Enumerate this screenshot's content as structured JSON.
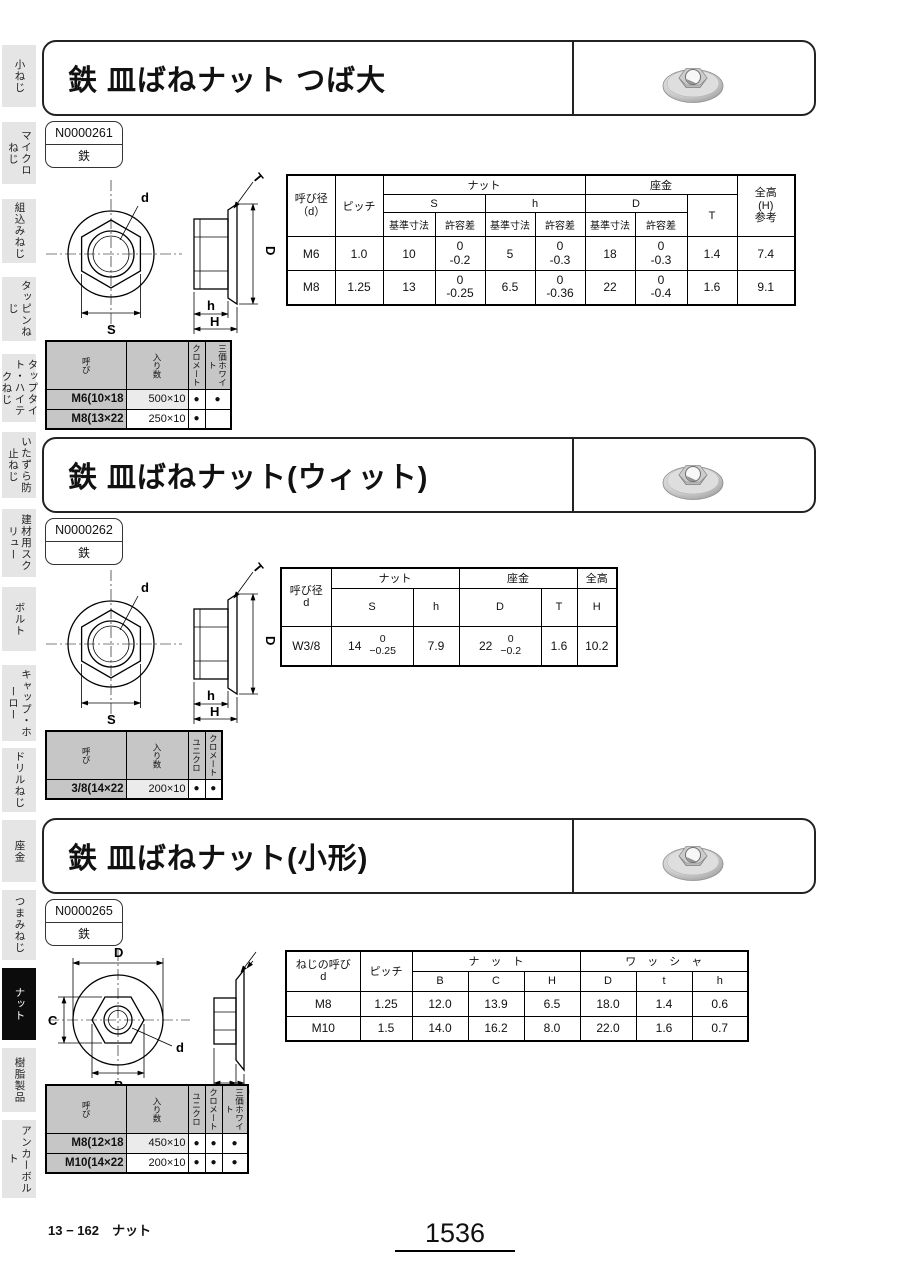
{
  "page": {
    "footer_left": "13 − 162　ナット",
    "footer_page": "1536"
  },
  "sidebar": {
    "items": [
      {
        "label": "小ねじ",
        "active": false
      },
      {
        "label": "マイクロねじ",
        "active": false
      },
      {
        "label": "組込みねじ",
        "active": false
      },
      {
        "label": "タッピンねじ",
        "active": false
      },
      {
        "label": "タップタイト・ハイテクねじ",
        "active": false
      },
      {
        "label": "いたずら防止ねじ",
        "active": false
      },
      {
        "label": "建材用スクリュー",
        "active": false
      },
      {
        "label": "ボルト",
        "active": false
      },
      {
        "label": "キャップ・ホーロー",
        "active": false
      },
      {
        "label": "ドリルねじ",
        "active": false
      },
      {
        "label": "座金",
        "active": false
      },
      {
        "label": "つまみねじ",
        "active": false
      },
      {
        "label": "ナット",
        "active": true
      },
      {
        "label": "樹脂製品",
        "active": false
      },
      {
        "label": "アンカーボルト",
        "active": false
      }
    ]
  },
  "sections": [
    {
      "title": "鉄 皿ばねナット つば大",
      "code": "N0000261",
      "material": "鉄",
      "drawing": {
        "d": "d",
        "S": "S",
        "T": "T",
        "D": "D",
        "h": "h",
        "H": "H"
      },
      "spec": {
        "h_name": "呼び径\n（d）",
        "h_pitch": "ピッチ",
        "h_nut": "ナット",
        "h_washer": "座金",
        "h_total": "全高\n(H)\n参考",
        "h_S": "S",
        "h_h": "h",
        "h_D": "D",
        "h_T": "T",
        "h_basic": "基準寸法",
        "h_tol": "許容差",
        "rows": [
          {
            "name": "M6",
            "pitch": "1.0",
            "s_basic": "10",
            "s_tol": "0\n-0.2",
            "h_basic": "5",
            "h_tol": "0\n-0.3",
            "d_basic": "18",
            "d_tol": "0\n-0.3",
            "t": "1.4",
            "total": "7.4"
          },
          {
            "name": "M8",
            "pitch": "1.25",
            "s_basic": "13",
            "s_tol": "0\n-0.25",
            "h_basic": "6.5",
            "h_tol": "0\n-0.36",
            "d_basic": "22",
            "d_tol": "0\n-0.4",
            "t": "1.6",
            "total": "9.1"
          }
        ]
      },
      "pack": {
        "h_name": "呼び",
        "h_qty": "入り数",
        "finishes": [
          "クロメート",
          "三価ホワイト"
        ],
        "rows": [
          {
            "name": "M6(10×18",
            "qty": "500×10",
            "dots": [
              "●",
              "●"
            ]
          },
          {
            "name": "M8(13×22",
            "qty": "250×10",
            "dots": [
              "●",
              ""
            ]
          }
        ]
      }
    },
    {
      "title": "鉄 皿ばねナット(ウィット)",
      "code": "N0000262",
      "material": "鉄",
      "drawing": {
        "d": "d",
        "S": "S",
        "T": "T",
        "D": "D",
        "h": "h",
        "H": "H"
      },
      "spec": {
        "h_name": "呼び径\nd",
        "h_nut": "ナット",
        "h_washer": "座金",
        "h_total": "全高",
        "h_S": "S",
        "h_h": "h",
        "h_D": "D",
        "h_T": "T",
        "h_H": "H",
        "rows": [
          {
            "name": "W3/8",
            "s_basic": "14",
            "s_tol": "0\n−0.25",
            "h": "7.9",
            "d_basic": "22",
            "d_tol": "0\n−0.2",
            "t": "1.6",
            "total": "10.2"
          }
        ]
      },
      "pack": {
        "h_name": "呼び",
        "h_qty": "入り数",
        "finishes": [
          "ユニクロ",
          "クロメート"
        ],
        "rows": [
          {
            "name": "3/8(14×22",
            "qty": "200×10",
            "dots": [
              "●",
              "●"
            ]
          }
        ]
      }
    },
    {
      "title": "鉄 皿ばねナット(小形)",
      "code": "N0000265",
      "material": "鉄",
      "drawing": {
        "D": "D",
        "C": "C",
        "B": "B",
        "d": "d",
        "H": "H",
        "h": "h"
      },
      "spec": {
        "h_name": "ねじの呼び\nd",
        "h_pitch": "ピッチ",
        "h_nut": "ナ　ッ　ト",
        "h_washer": "ワ　ッ　シ　ャ",
        "cols_nut": [
          "B",
          "C",
          "H"
        ],
        "cols_washer": [
          "D",
          "t",
          "h"
        ],
        "rows": [
          {
            "name": "M8",
            "pitch": "1.25",
            "vals": [
              "12.0",
              "13.9",
              "6.5",
              "18.0",
              "1.4",
              "0.6"
            ]
          },
          {
            "name": "M10",
            "pitch": "1.5",
            "vals": [
              "14.0",
              "16.2",
              "8.0",
              "22.0",
              "1.6",
              "0.7"
            ]
          }
        ]
      },
      "pack": {
        "h_name": "呼び",
        "h_qty": "入り数",
        "finishes": [
          "ユニクロ",
          "クロメート",
          "三価ホワイト"
        ],
        "rows": [
          {
            "name": "M8(12×18",
            "qty": "450×10",
            "dots": [
              "●",
              "●",
              "●"
            ]
          },
          {
            "name": "M10(14×22",
            "qty": "200×10",
            "dots": [
              "●",
              "●",
              "●"
            ]
          }
        ]
      }
    }
  ]
}
